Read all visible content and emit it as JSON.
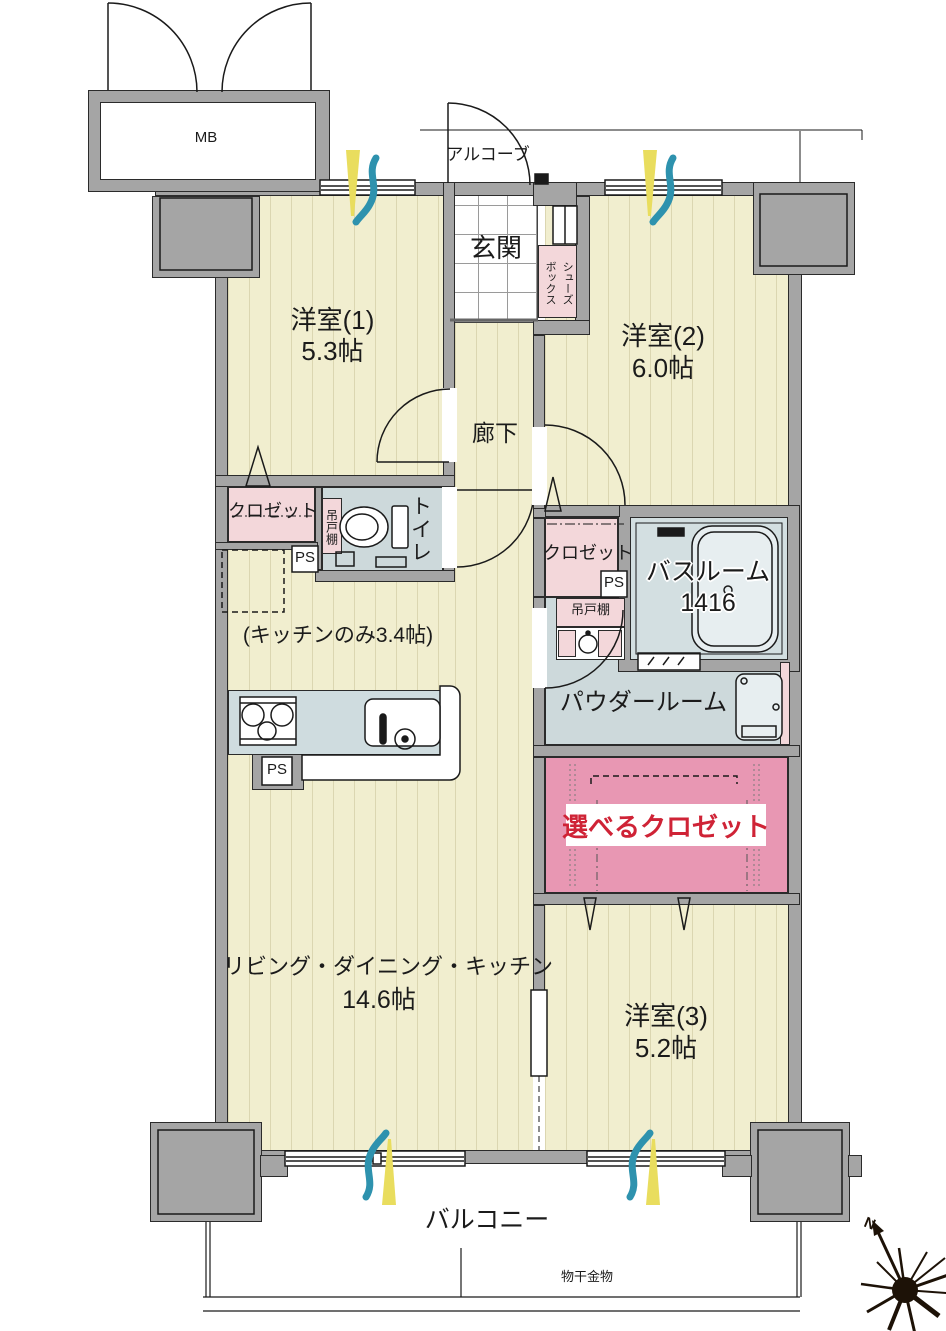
{
  "labels": {
    "mb": "MB",
    "alcove": "アルコーブ",
    "genkan": "玄関",
    "shoes_line1": "シューズ",
    "shoes_line2": "ボックス",
    "room1_name": "洋室(1)",
    "room1_size": "5.3帖",
    "room2_name": "洋室(2)",
    "room2_size": "6.0帖",
    "room3_name": "洋室(3)",
    "room3_size": "5.2帖",
    "hallway": "廊下",
    "closet_left": "クロゼット",
    "closet_right": "クロゼット",
    "toilet": "トイレ",
    "cupboard_toilet": "吊戸棚",
    "cupboard_powder": "吊戸棚",
    "ps1": "PS",
    "ps2": "PS",
    "ps3": "PS",
    "bathroom_name": "バスルーム",
    "bathroom_size": "1416",
    "powder_room": "パウダールーム",
    "kitchen_note": "(キッチンのみ3.4帖)",
    "ldk_name": "リビング・ダイニング・キッチン",
    "ldk_size": "14.6帖",
    "selectable_closet": "選べるクロゼット",
    "balcony": "バルコニー",
    "laundry_hw": "物干金物",
    "compass_n": "N"
  },
  "colors": {
    "wall": "#a5a5a5",
    "floor": "#f1eecf",
    "wet_area": "#cdd9db",
    "closet_pink": "#f3d7da",
    "accent_pink": "#e897b3",
    "accent_red": "#cf2336",
    "breeze_yellow": "#e9dd5e",
    "breeze_teal": "#2e92ae"
  }
}
